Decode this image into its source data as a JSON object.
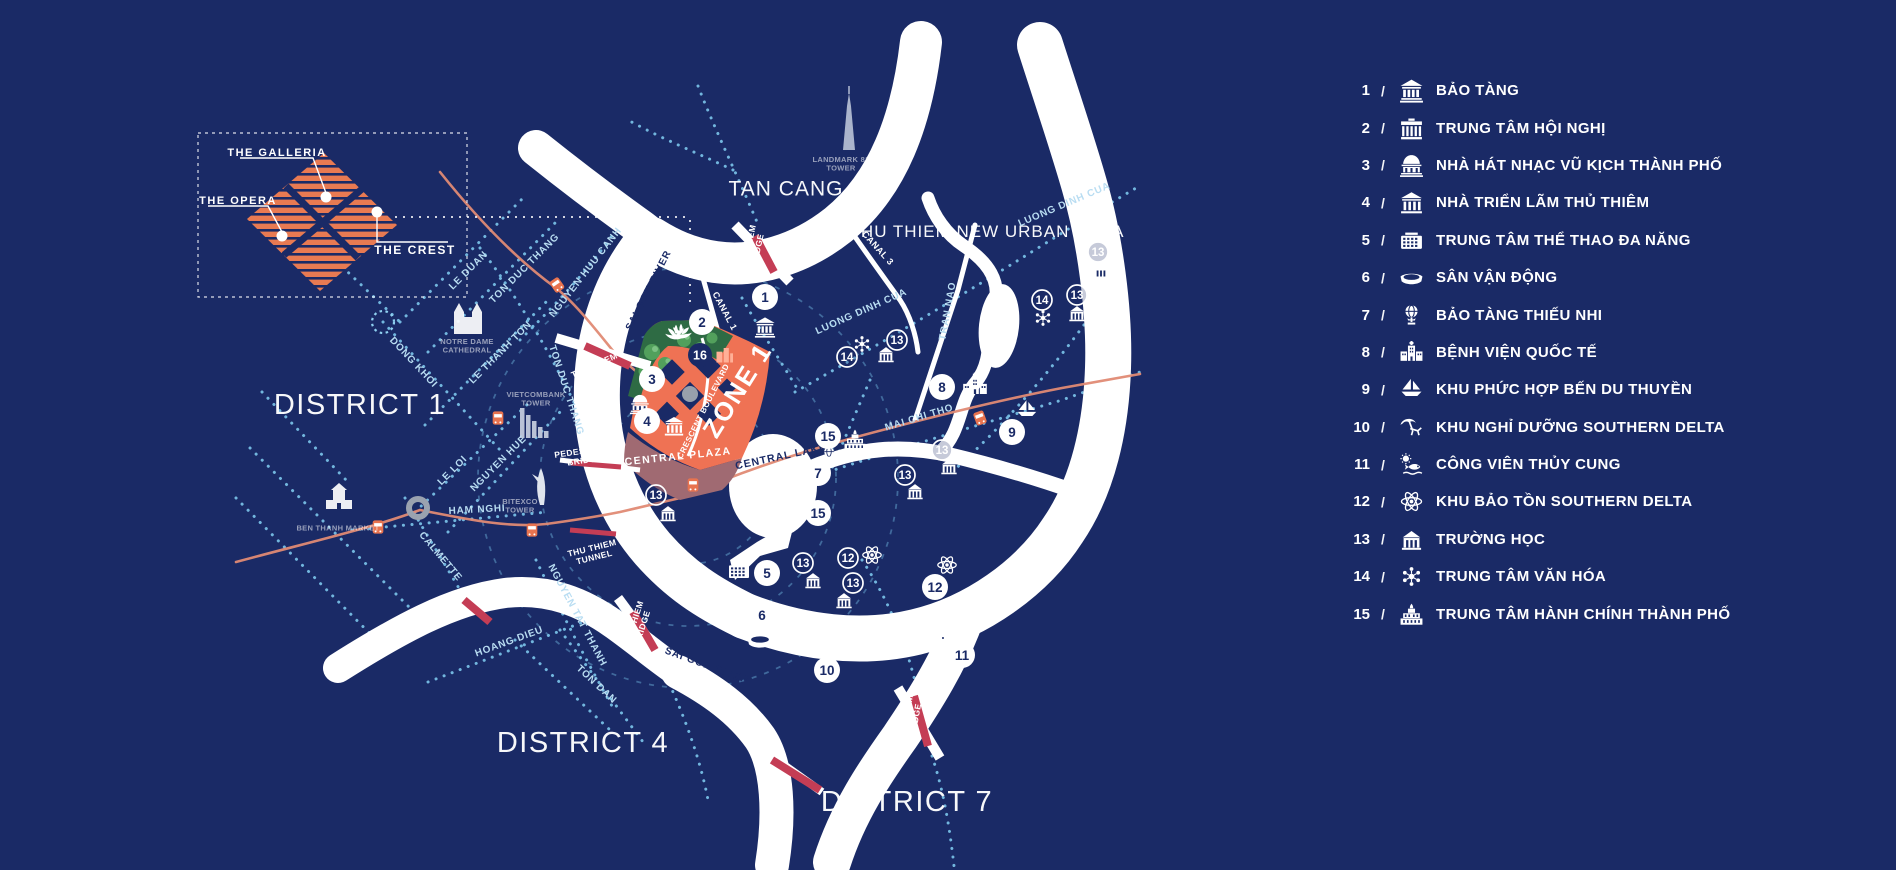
{
  "colors": {
    "background": "#1a2a66",
    "water": "#ffffff",
    "road_dots": "#79c2e8",
    "rail_line": "#e08a74",
    "bridge_red": "#c43d55",
    "zone_orange": "#ef7254",
    "plaza_mauve": "#a06a72",
    "park_green": "#2e6b44",
    "tree_green": "#52a05c",
    "marker_navy": "#1a2a66",
    "legend_text": "#ffffff",
    "inset_orange": "#e87a52"
  },
  "inset": {
    "labels": {
      "galleria": "THE GALLERIA",
      "opera": "THE OPERA",
      "crest": "THE CREST"
    }
  },
  "legend": {
    "separator": "/",
    "items": [
      {
        "num": "1",
        "icon": "museum",
        "label": "BẢO TÀNG"
      },
      {
        "num": "2",
        "icon": "convention",
        "label": "TRUNG TÂM HỘI NGHỊ"
      },
      {
        "num": "3",
        "icon": "opera",
        "label": "NHÀ HÁT NHẠC VŨ KỊCH THÀNH PHỐ"
      },
      {
        "num": "4",
        "icon": "exhibition",
        "label": "NHÀ TRIỂN LÃM THỦ THIÊM"
      },
      {
        "num": "5",
        "icon": "sports",
        "label": "TRUNG TÂM THỂ THAO ĐA NĂNG"
      },
      {
        "num": "6",
        "icon": "stadium",
        "label": "SÂN VẬN ĐỘNG"
      },
      {
        "num": "7",
        "icon": "globe",
        "label": "BẢO TÀNG THIẾU NHI"
      },
      {
        "num": "8",
        "icon": "hospital",
        "label": "BỆNH VIỆN QUỐC TẾ"
      },
      {
        "num": "9",
        "icon": "sailboat",
        "label": "KHU PHỨC HỢP BẾN DU THUYỀN"
      },
      {
        "num": "10",
        "icon": "resort",
        "label": "KHU NGHỈ DƯỠNG SOUTHERN DELTA"
      },
      {
        "num": "11",
        "icon": "aquarium",
        "label": "CÔNG VIÊN THỦY CUNG"
      },
      {
        "num": "12",
        "icon": "atom",
        "label": "KHU BẢO TỒN SOUTHERN DELTA"
      },
      {
        "num": "13",
        "icon": "school",
        "label": "TRƯỜNG HỌC"
      },
      {
        "num": "14",
        "icon": "culture",
        "label": "TRUNG TÂM VĂN HÓA"
      },
      {
        "num": "15",
        "icon": "cityhall",
        "label": "TRUNG TÂM HÀNH CHÍNH THÀNH PHỐ"
      }
    ]
  },
  "map": {
    "labels": [
      {
        "t": "DISTRICT 1",
        "x": 360,
        "y": 404,
        "r": 0,
        "s": 29,
        "c": "big",
        "ls": 1.5
      },
      {
        "t": "DISTRICT 4",
        "x": 583,
        "y": 742,
        "r": 0,
        "s": 29,
        "c": "big",
        "ls": 1.5
      },
      {
        "t": "DISTRICT 7",
        "x": 907,
        "y": 801,
        "r": 0,
        "s": 29,
        "c": "big",
        "ls": 1.5
      },
      {
        "t": "TAN CANG",
        "x": 786,
        "y": 188,
        "r": 0,
        "s": 21,
        "c": "big",
        "ls": 1
      },
      {
        "t": "THU THIEM NEW URBAN AREA",
        "x": 987,
        "y": 231,
        "r": 0,
        "s": 17,
        "c": "big",
        "ls": 1
      },
      {
        "t": "ZONE 1",
        "x": 737,
        "y": 390,
        "r": -58,
        "s": 26,
        "c": "white",
        "ls": 2
      },
      {
        "t": "CRESCENT BOULEVARD",
        "x": 703,
        "y": 411,
        "r": -63,
        "s": 8,
        "c": "white",
        "ls": 0.5
      },
      {
        "t": "CENTRAL PLAZA",
        "x": 678,
        "y": 456,
        "r": -6,
        "s": 10.5,
        "c": "white",
        "ls": 1.5
      },
      {
        "t": "CENTRAL LAKE",
        "x": 781,
        "y": 456,
        "r": -12,
        "s": 10.5,
        "c": "navy",
        "ls": 1
      },
      {
        "t": "SAI GON RIVER",
        "x": 648,
        "y": 290,
        "r": -63,
        "s": 10,
        "c": "navy",
        "ls": 1
      },
      {
        "t": "SAI GON RIVER",
        "x": 707,
        "y": 665,
        "r": 20,
        "s": 10,
        "c": "navy",
        "ls": 1
      },
      {
        "t": "CANAL 1",
        "x": 725,
        "y": 311,
        "r": 62,
        "s": 9,
        "c": "white",
        "ls": 0.5
      },
      {
        "t": "CANAL 3",
        "x": 878,
        "y": 248,
        "r": 48,
        "s": 9,
        "c": "white",
        "ls": 0.5
      },
      {
        "t": "LE DUAN",
        "x": 468,
        "y": 270,
        "r": -45,
        "s": 10,
        "c": "road",
        "ls": 0.8
      },
      {
        "t": "TON DUC THANG",
        "x": 524,
        "y": 268,
        "r": -45,
        "s": 10,
        "c": "road",
        "ls": 0.8
      },
      {
        "t": "LE THANH TON",
        "x": 500,
        "y": 352,
        "r": -45,
        "s": 10,
        "c": "road",
        "ls": 0.8
      },
      {
        "t": "NGUYEN HUU CANH",
        "x": 585,
        "y": 272,
        "r": -52,
        "s": 10,
        "c": "road",
        "ls": 0.8
      },
      {
        "t": "DONG KHOI",
        "x": 414,
        "y": 362,
        "r": 47,
        "s": 10,
        "c": "road",
        "ls": 0.8
      },
      {
        "t": "TON DUC THANG",
        "x": 567,
        "y": 390,
        "r": 72,
        "s": 10,
        "c": "road",
        "ls": 0.8
      },
      {
        "t": "NGUYEN HUE",
        "x": 498,
        "y": 463,
        "r": -45,
        "s": 10,
        "c": "road",
        "ls": 0.8
      },
      {
        "t": "LE LOI",
        "x": 452,
        "y": 470,
        "r": -45,
        "s": 10,
        "c": "road",
        "ls": 0.8
      },
      {
        "t": "HAM NGHI",
        "x": 477,
        "y": 509,
        "r": -3,
        "s": 10,
        "c": "road",
        "ls": 0.8
      },
      {
        "t": "CALMETTE",
        "x": 441,
        "y": 556,
        "r": 50,
        "s": 10,
        "c": "road",
        "ls": 0.8
      },
      {
        "t": "NGUYEN TAT THANH",
        "x": 578,
        "y": 615,
        "r": 62,
        "s": 10,
        "c": "road",
        "ls": 0.8
      },
      {
        "t": "HOANG DIEU",
        "x": 509,
        "y": 641,
        "r": -20,
        "s": 10,
        "c": "road",
        "ls": 0.8
      },
      {
        "t": "TON DAN",
        "x": 597,
        "y": 684,
        "r": 43,
        "s": 10,
        "c": "road",
        "ls": 0.8
      },
      {
        "t": "LUONG DINH CUA",
        "x": 1064,
        "y": 204,
        "r": -23,
        "s": 10,
        "c": "road",
        "ls": 0.8
      },
      {
        "t": "LUONG DINH CUA",
        "x": 861,
        "y": 311,
        "r": -24,
        "s": 10,
        "c": "road",
        "ls": 0.8
      },
      {
        "t": "TRAN NAO",
        "x": 947,
        "y": 311,
        "r": -80,
        "s": 10,
        "c": "road",
        "ls": 0.8
      },
      {
        "t": "MAI CHI THO",
        "x": 919,
        "y": 417,
        "r": -17,
        "s": 10,
        "c": "road",
        "ls": 0.8
      },
      {
        "t": "THU THIEM\nBRIDGE",
        "x": 752,
        "y": 250,
        "r": -78,
        "s": 8.5,
        "c": "white",
        "ls": 0.4
      },
      {
        "t": "THU THIEM\nBRIDGE",
        "x": 596,
        "y": 369,
        "r": -24,
        "s": 8.5,
        "c": "white",
        "ls": 0.4
      },
      {
        "t": "THU THIEM\nBRIDGE",
        "x": 637,
        "y": 626,
        "r": -72,
        "s": 8.5,
        "c": "white",
        "ls": 0.4
      },
      {
        "t": "THU THIEM\nBRIDGE",
        "x": 910,
        "y": 720,
        "r": -80,
        "s": 8.5,
        "c": "white",
        "ls": 0.4
      },
      {
        "t": "PEDESTRIAN\nBRIDGE",
        "x": 584,
        "y": 455,
        "r": -8,
        "s": 8.5,
        "c": "white",
        "ls": 0.4
      },
      {
        "t": "THU THIEM\nTUNNEL",
        "x": 593,
        "y": 552,
        "r": -14,
        "s": 8.5,
        "c": "white",
        "ls": 0.4
      },
      {
        "t": "NOTRE DAME\nCATHEDRAL",
        "x": 467,
        "y": 345,
        "r": 0,
        "s": 7.5,
        "c": "muted",
        "ls": 0.3
      },
      {
        "t": "VIETCOMBANK\nTOWER",
        "x": 536,
        "y": 398,
        "r": 0,
        "s": 7.5,
        "c": "muted",
        "ls": 0.3
      },
      {
        "t": "BITEXCO\nTOWER",
        "x": 520,
        "y": 505,
        "r": 0,
        "s": 7.5,
        "c": "muted",
        "ls": 0.3
      },
      {
        "t": "BEN THANH MARKET",
        "x": 338,
        "y": 528,
        "r": 0,
        "s": 7.5,
        "c": "muted",
        "ls": 0.3
      },
      {
        "t": "LANDMARK 81\nTOWER",
        "x": 841,
        "y": 163,
        "r": 0,
        "s": 7.5,
        "c": "muted",
        "ls": 0.3
      },
      {
        "t": "THE GALLERIA",
        "x": 277,
        "y": 152,
        "r": 0,
        "s": 11,
        "c": "white",
        "ls": 1.5
      },
      {
        "t": "THE OPERA",
        "x": 238,
        "y": 200,
        "r": 0,
        "s": 11,
        "c": "white",
        "ls": 1.5
      },
      {
        "t": "THE CREST",
        "x": 415,
        "y": 250,
        "r": 0,
        "s": 12,
        "c": "white",
        "ls": 1.5
      }
    ],
    "markers": [
      {
        "n": "1",
        "x": 765,
        "y": 297,
        "style": "solid",
        "icon": "museum",
        "ix": 765,
        "iy": 327,
        "isz": 22
      },
      {
        "n": "2",
        "x": 702,
        "y": 322,
        "style": "solid",
        "icon": "lotus",
        "ix": 676,
        "iy": 334,
        "isz": 26
      },
      {
        "n": "3",
        "x": 652,
        "y": 379,
        "style": "solid",
        "icon": "opera",
        "ix": 640,
        "iy": 404,
        "isz": 22
      },
      {
        "n": "4",
        "x": 647,
        "y": 421,
        "style": "solid",
        "icon": "exhibition",
        "ix": 674,
        "iy": 426,
        "isz": 22
      },
      {
        "n": "5",
        "x": 767,
        "y": 573,
        "style": "solid",
        "icon": "sports",
        "ix": 739,
        "iy": 570,
        "isz": 24
      },
      {
        "n": "6",
        "x": 762,
        "y": 615,
        "style": "solid",
        "icon": "stadium",
        "ix": 760,
        "iy": 640,
        "isz": 28
      },
      {
        "n": "7",
        "x": 818,
        "y": 473,
        "style": "solid",
        "icon": "globe",
        "ix": 829,
        "iy": 455,
        "isz": 20
      },
      {
        "n": "8",
        "x": 942,
        "y": 387,
        "style": "solid",
        "icon": "hospital",
        "ix": 975,
        "iy": 385,
        "isz": 27
      },
      {
        "n": "9",
        "x": 1012,
        "y": 432,
        "style": "solid",
        "icon": "sailboat",
        "ix": 1027,
        "iy": 410,
        "isz": 23
      },
      {
        "n": "10",
        "x": 827,
        "y": 670,
        "style": "solid",
        "icon": "resort",
        "ix": 828,
        "iy": 642,
        "isz": 27
      },
      {
        "n": "11",
        "x": 962,
        "y": 655,
        "style": "solid",
        "icon": "aquarium",
        "ix": 936,
        "iy": 636,
        "isz": 27
      },
      {
        "n": "12",
        "x": 848,
        "y": 558,
        "style": "outline",
        "icon": "atom",
        "ix": 872,
        "iy": 555,
        "isz": 23
      },
      {
        "n": "12",
        "x": 935,
        "y": 587,
        "style": "solid",
        "icon": "atom",
        "ix": 947,
        "iy": 565,
        "isz": 23
      },
      {
        "n": "13",
        "x": 656,
        "y": 495,
        "style": "outline",
        "icon": "school",
        "ix": 668,
        "iy": 513,
        "isz": 20
      },
      {
        "n": "13",
        "x": 803,
        "y": 563,
        "style": "outline",
        "icon": "school",
        "ix": 813,
        "iy": 580,
        "isz": 20
      },
      {
        "n": "13",
        "x": 853,
        "y": 583,
        "style": "outline",
        "icon": "school",
        "ix": 844,
        "iy": 600,
        "isz": 20
      },
      {
        "n": "13",
        "x": 905,
        "y": 475,
        "style": "outline",
        "icon": "school",
        "ix": 915,
        "iy": 491,
        "isz": 20
      },
      {
        "n": "13",
        "x": 942,
        "y": 450,
        "style": "outline",
        "icon": "school",
        "ix": 949,
        "iy": 466,
        "isz": 20
      },
      {
        "n": "13",
        "x": 1077,
        "y": 295,
        "style": "outline",
        "icon": "school",
        "ix": 1077,
        "iy": 313,
        "isz": 20
      },
      {
        "n": "13",
        "x": 1098,
        "y": 252,
        "style": "outline",
        "icon": "school",
        "ix": 1101,
        "iy": 270,
        "isz": 20
      },
      {
        "n": "13",
        "x": 897,
        "y": 340,
        "style": "outline",
        "icon": "school",
        "ix": 886,
        "iy": 354,
        "isz": 20
      },
      {
        "n": "14",
        "x": 1042,
        "y": 300,
        "style": "outline",
        "icon": "culture",
        "ix": 1043,
        "iy": 318,
        "isz": 21
      },
      {
        "n": "14",
        "x": 847,
        "y": 357,
        "style": "outline",
        "icon": "culture",
        "ix": 862,
        "iy": 344,
        "isz": 21
      },
      {
        "n": "15",
        "x": 828,
        "y": 436,
        "style": "solid",
        "icon": "cityhall",
        "ix": 855,
        "iy": 440,
        "isz": 24
      },
      {
        "n": "15",
        "x": 818,
        "y": 513,
        "style": "solid"
      },
      {
        "n": "16",
        "x": 700,
        "y": 355,
        "style": "navy",
        "icon": "buildings",
        "ix": 724,
        "iy": 355,
        "isz": 20
      }
    ]
  }
}
